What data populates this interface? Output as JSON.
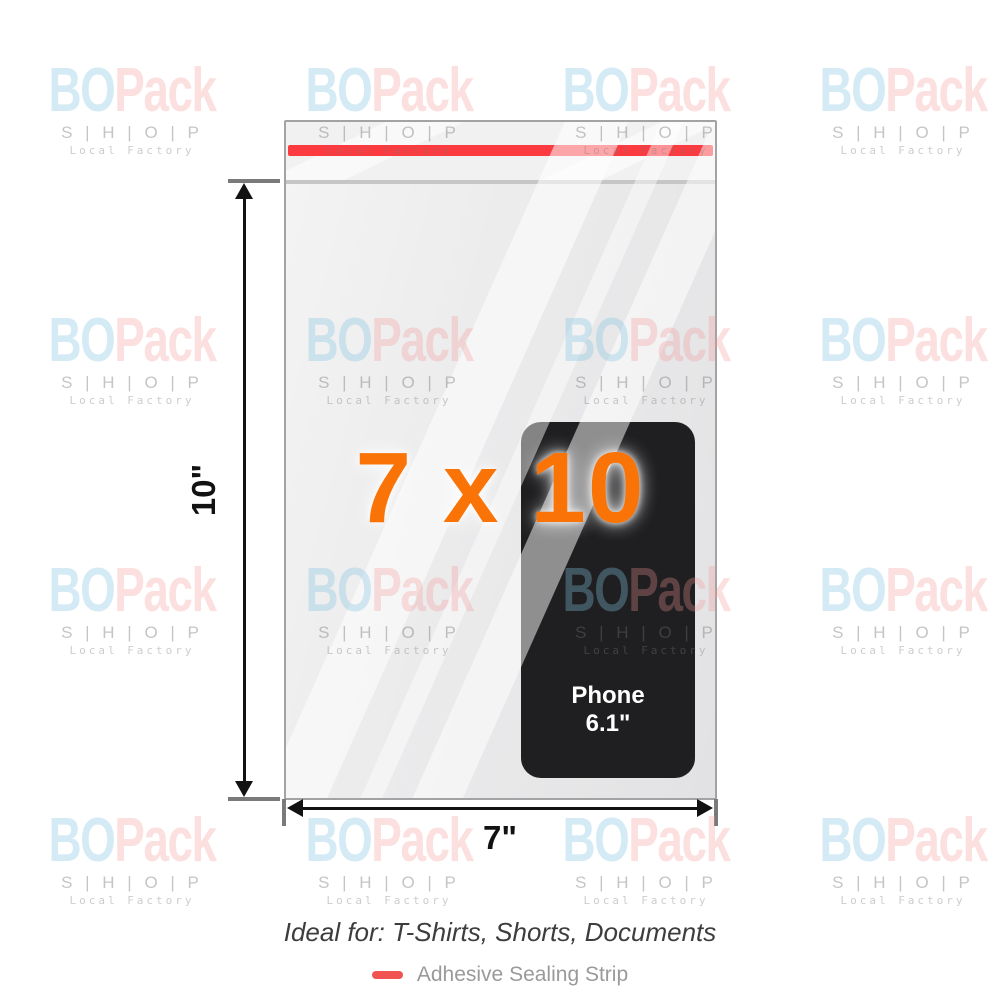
{
  "watermark": {
    "brand_first": "BO",
    "brand_second": "Pack",
    "shop_line": "S | H | O | P",
    "tagline": "Local Factory"
  },
  "bag": {
    "size_label": "7 x 10",
    "height_label": "10\"",
    "width_label": "7\"",
    "phone": {
      "line1": "Phone",
      "line2": "6.1\""
    }
  },
  "colors": {
    "accent_orange": "#FA7306",
    "sealing_strip": "#FB3B40",
    "legend_swatch": "#F25252"
  },
  "caption": {
    "ideal_for": "Ideal for: T-Shirts, Shorts, Documents"
  },
  "legend": {
    "label": "Adhesive Sealing Strip"
  }
}
